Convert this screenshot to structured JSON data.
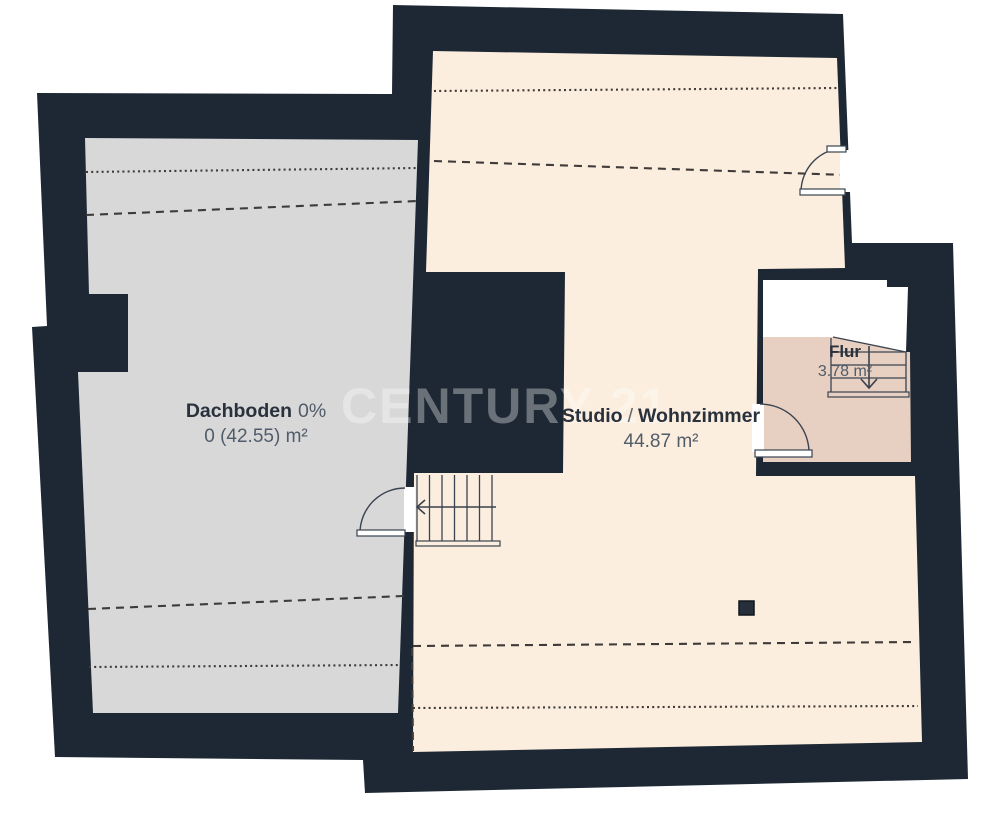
{
  "watermark": {
    "text": "CENTURY 21"
  },
  "colors": {
    "wall": "#1d2834",
    "void": "#ffffff",
    "door_opening": "#ffffff",
    "chimney": "#26303c",
    "dashed_lines": "#3f3b38",
    "thin_lines": "#3a4350"
  },
  "rooms": {
    "dachboden": {
      "name": "Dachboden",
      "occupancy": "0%",
      "area": "0 (42.55) m²",
      "fill": "#d8d8d9"
    },
    "studio": {
      "name": "Studio",
      "separator": "/",
      "name2": "Wohnzimmer",
      "area": "44.87 m²",
      "fill": "#fceede"
    },
    "flur": {
      "name": "Flur",
      "area": "3.78 m²",
      "fill": "#e7cfc1"
    }
  }
}
